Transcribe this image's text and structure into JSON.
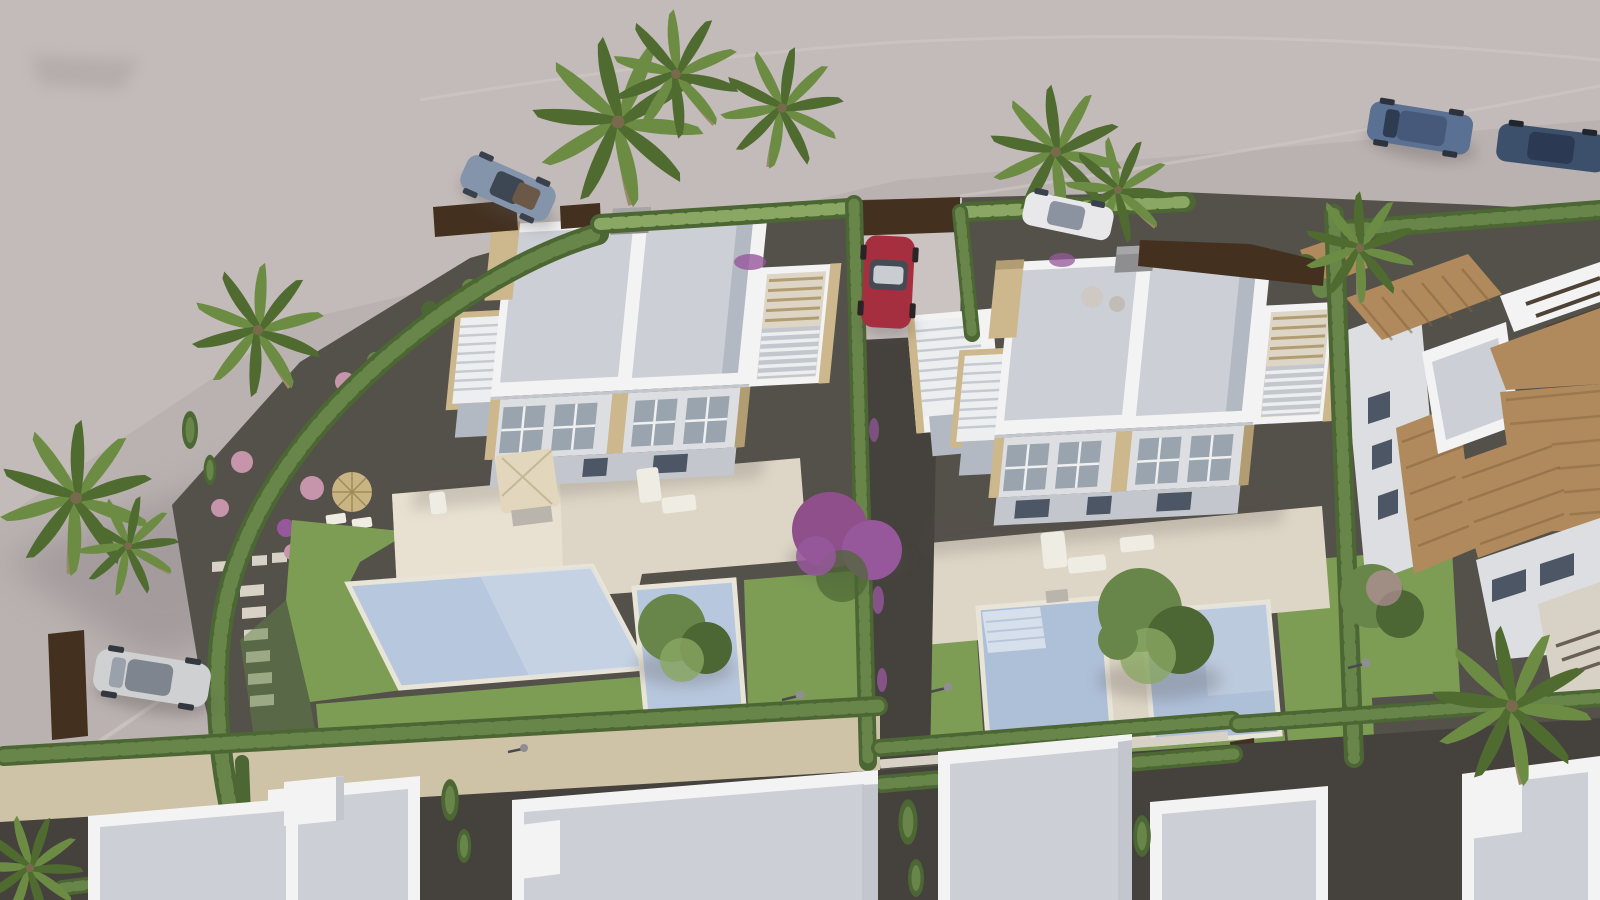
{
  "scene": {
    "type": "aerial-3d-architectural-render",
    "description": "Aerial rendering of a new-build residential development: two white modern duplex villas with flat grey roofs, roof solariums and external staircases, four private swimming pools, cream terraces, lawns, cypress hedges, gravel gardens with palm trees, parked cars on the surrounding road, traditional terracotta-roofed houses on the right and a row of white flat-roofed houses along the bottom.",
    "counts": {
      "modern_villas": 2,
      "swimming_pools": 4,
      "cars": 6,
      "palm_trees": 8,
      "traditional_houses": 3,
      "bottom_row_houses": 5
    }
  },
  "palette": {
    "ground": "#bab2b0",
    "groundLight": "#cac3c1",
    "roadShadow": "#8d8589",
    "curb": "#d2cbc8",
    "gravel": "#54504a",
    "gravelDark": "#45413c",
    "lawn": "#7d9d55",
    "lawnShade": "#5e7f41",
    "hedge": "#68854a",
    "hedgeDark": "#4c6634",
    "hedgeLight": "#8aa863",
    "poolWater": "#b7c7dd",
    "poolWater2": "#aebfd8",
    "poolLight": "#d6e0ec",
    "coping": "#e9e4d8",
    "terrace": "#ddd5c5",
    "terraceLight": "#ece5d6",
    "wallWhite": "#f3f3f4",
    "wallShade": "#dcdee1",
    "wallDark": "#c3c7cd",
    "roofGray": "#ccd0d6",
    "roofGrayDark": "#b3b9c2",
    "winGlass": "#9aa4ae",
    "winDark": "#4c5664",
    "stone": "#cdb88d",
    "stoneDark": "#b29c72",
    "terracotta": "#b08a5c",
    "terracottaDark": "#85653f",
    "woodDark": "#4e4236",
    "brownWall": "#43301f",
    "pathStone": "#d8d2c6",
    "stoneWall": "#cec2a7",
    "stepsWhite": "#eceef0",
    "stepsGap": "#c5cad1",
    "acGray": "#8e8e90",
    "acGrayLight": "#a6a6a8",
    "carRed": "#a62f3f",
    "carSilver": "#cfd0d2",
    "carBlueGray": "#8494ab",
    "carBlue": "#5b7193",
    "carDark": "#3c506b",
    "carWhite": "#e8e8ea",
    "glassDark": "#3d4754",
    "palmGreen": "#6d8c43",
    "palmDark": "#4f6b30",
    "trunk": "#9b8a6a",
    "flowerPink": "#c795ab",
    "flowerPurple": "#96589b",
    "bougainvillea": "#8f4f8b",
    "strawParasol": "#c9b483",
    "creamParasol": "#e2d7bd",
    "furniture": "#efece4",
    "furnitureGray": "#b9b4ac",
    "shadow": "#55504e"
  }
}
